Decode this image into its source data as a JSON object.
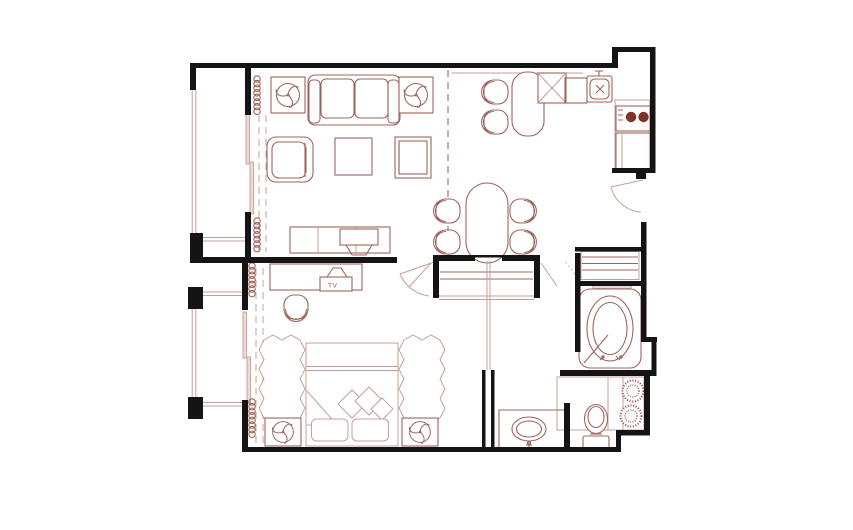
{
  "window": {
    "background": "#ffffff"
  },
  "floor_plan": {
    "type": "floor-plan",
    "labels": {
      "tv": "TV"
    },
    "colors": {
      "bg": "#ffffff",
      "wall": "#141414",
      "line": "#9e655d",
      "line_light": "#c4a198",
      "accent_dark": "#7e332c",
      "tile": "#d9bcb5",
      "hatch": "#9a544b",
      "panel": "#ecdad5"
    },
    "fixtures": [
      "sofa",
      "armchair",
      "accent-chair",
      "coffee-table",
      "side-table",
      "ceiling-fan-symbol",
      "tv-console",
      "bar-counter",
      "bar-stool",
      "corner-cabinet",
      "dishwasher",
      "kitchen-sink",
      "stove",
      "refrigerator",
      "dining-table",
      "dining-chair",
      "entry-door",
      "closet",
      "bedroom-door",
      "desk",
      "tv",
      "desk-chair",
      "bed",
      "pillow",
      "rug",
      "nightstand",
      "sliding-door",
      "curtain",
      "balcony",
      "bathtub",
      "linen-closet",
      "vanity-sink",
      "toilet",
      "tiled-floor",
      "privacy-screen",
      "plant",
      "pocket-door"
    ]
  }
}
